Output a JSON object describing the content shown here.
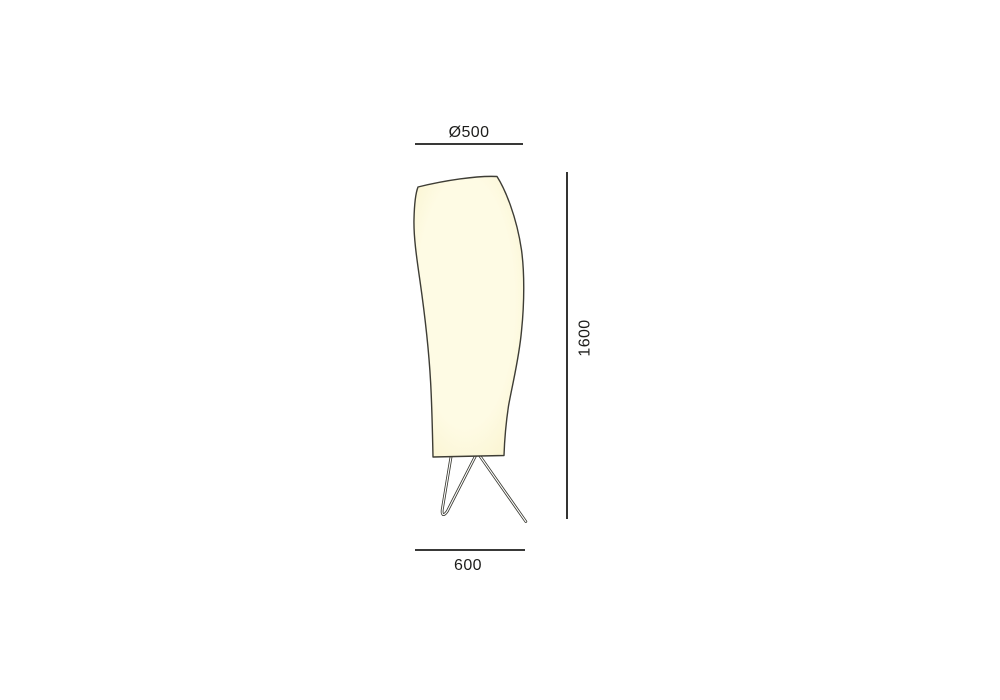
{
  "drawing": {
    "labels": {
      "diameter": "Ø500",
      "height": "1600",
      "base_width": "600"
    },
    "colors": {
      "dimension_line": "#1d1d1b",
      "label_text": "#1d1d1b",
      "shade_outline": "#3e3d35",
      "shade_fill_center": "#fefbe4",
      "shade_fill_edge": "#f9f2cb",
      "leg_stroke": "#3a3a32",
      "background": "#ffffff"
    }
  }
}
